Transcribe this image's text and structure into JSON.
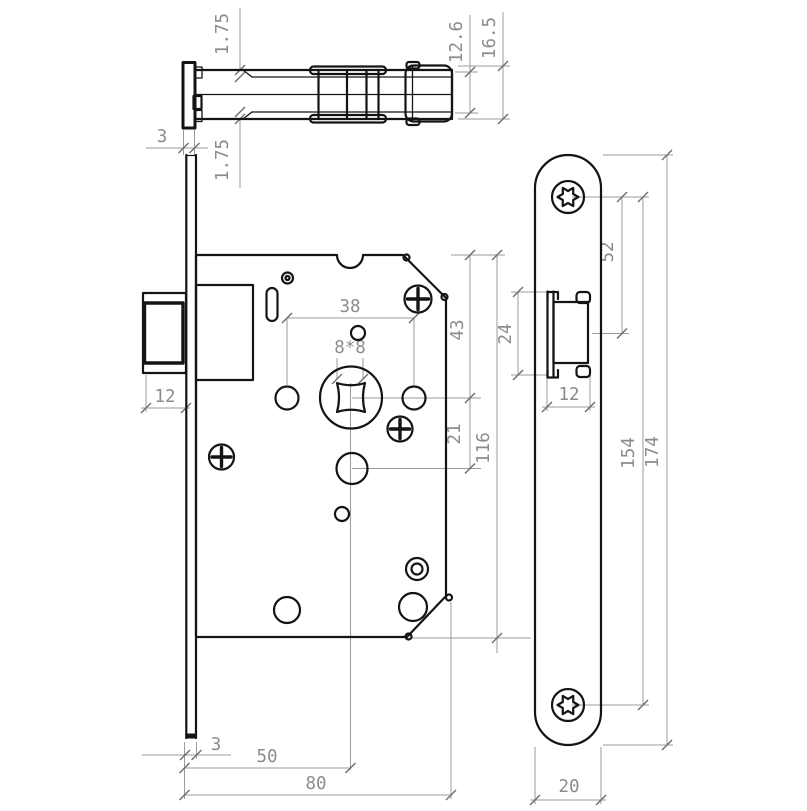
{
  "drawing": {
    "type": "technical drawing",
    "colors": {
      "line": "#141414",
      "dimension_line": "#9b9b9b",
      "dimension_text": "#8c8c8c",
      "background": "#ffffff"
    },
    "top_view": {
      "dims": {
        "bevel_top": "1.75",
        "bevel_bottom": "1.75",
        "faceplate_thickness": "3",
        "bolt_height": "12.6",
        "overall_height": "16.5"
      }
    },
    "front_view": {
      "dims": {
        "handle_hole_spacing": "38",
        "spindle_square": "8*8",
        "bolt_protrusion": "12",
        "top_to_spindle": "43",
        "spindle_to_follower": "21",
        "case_height": "116",
        "faceplate_thickness": "3",
        "backset": "50",
        "case_depth": "80"
      }
    },
    "side_view": {
      "dims": {
        "screw_to_bolt": "52",
        "bolt_height": "24",
        "bolt_width": "12",
        "screw_spacing": "154",
        "plate_length": "174",
        "plate_width": "20"
      }
    }
  }
}
